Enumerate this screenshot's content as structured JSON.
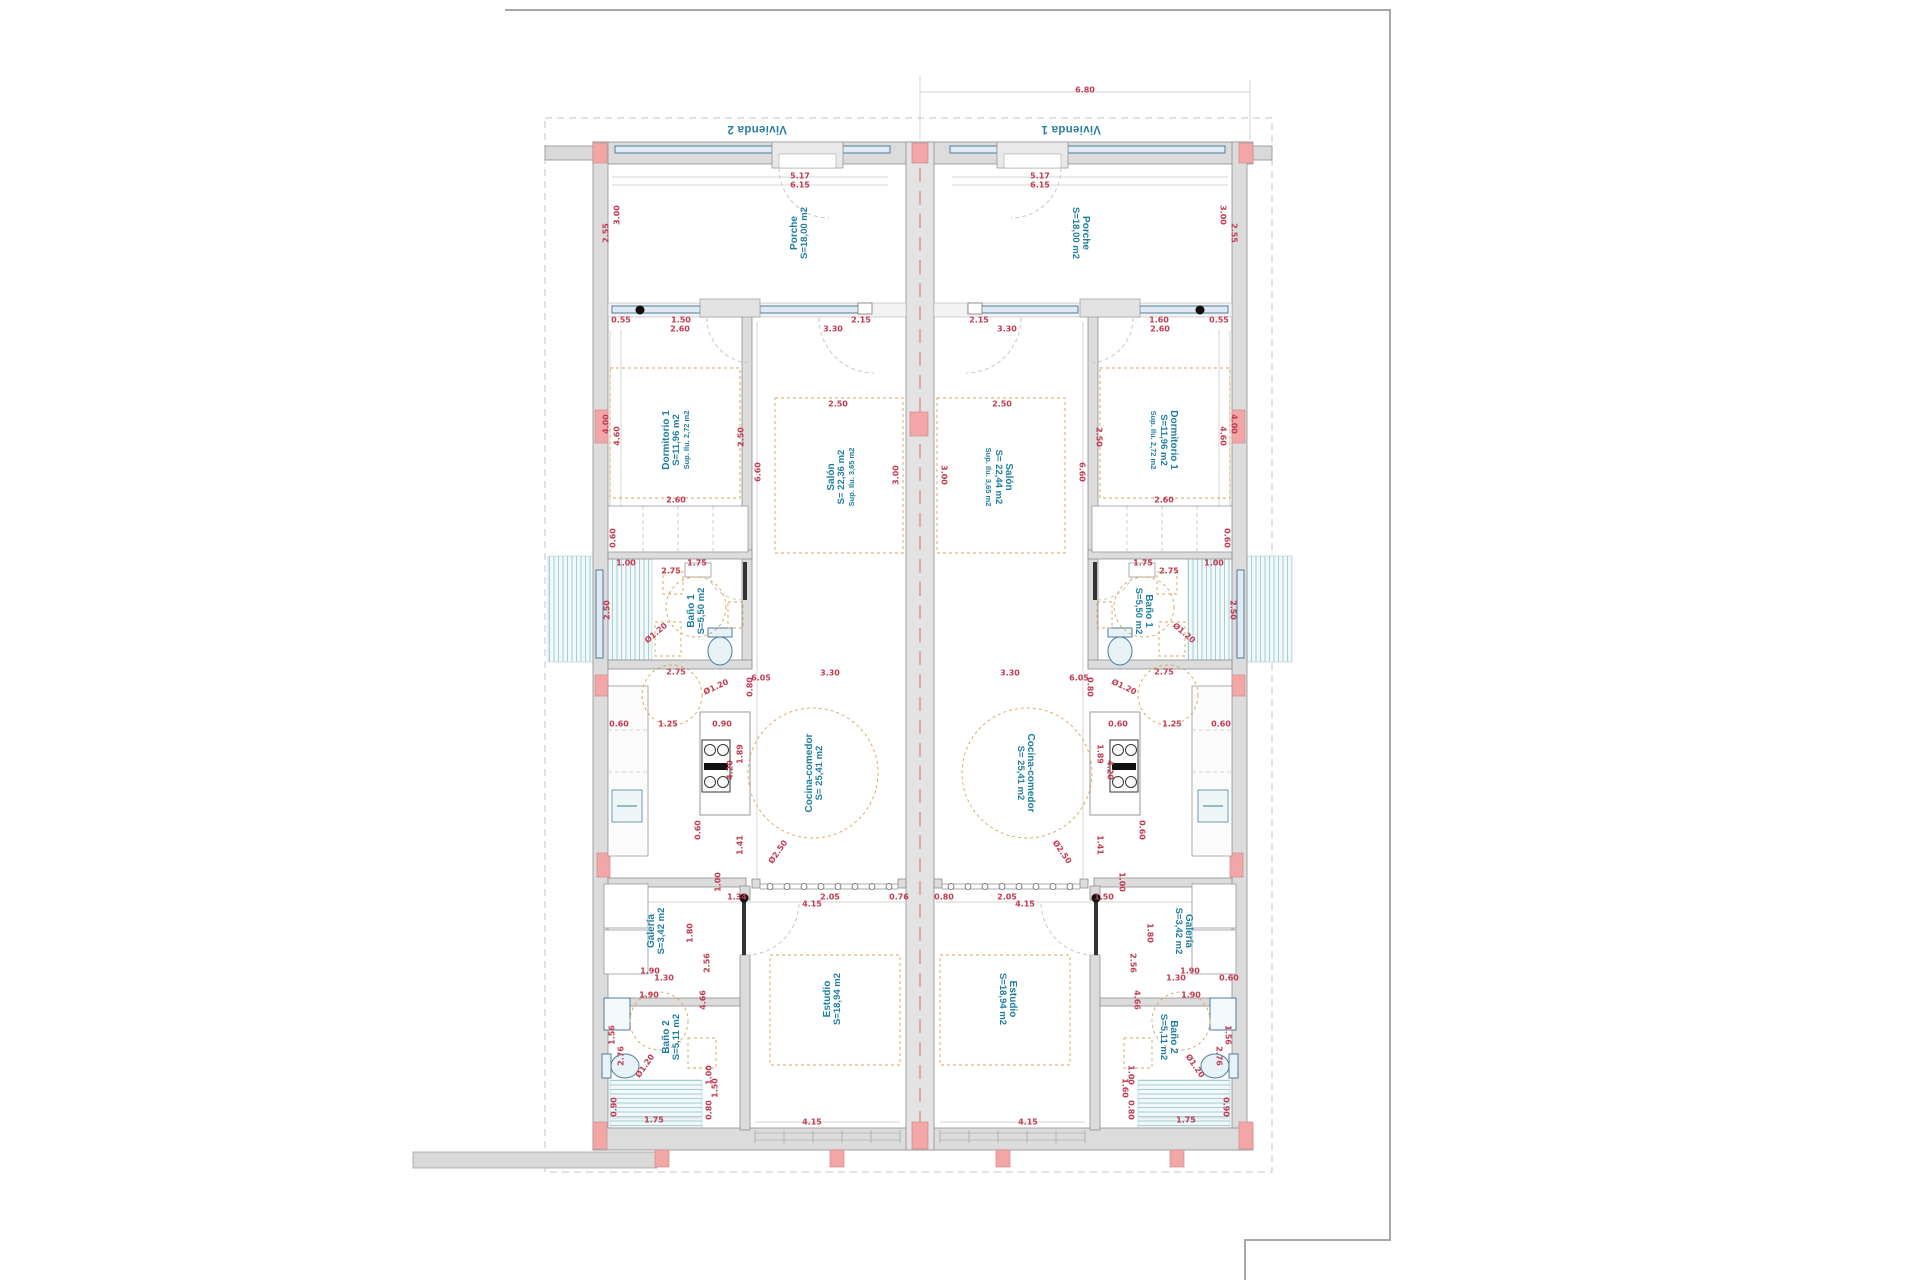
{
  "drawing_title": "floor-plan-two-mirrored-dwellings",
  "colors": {
    "wall_fill": "#dcdcdc",
    "wall_stroke": "#8f8f8f",
    "column_pink": "#f2a6a6",
    "window_blue": "#4e7d9e",
    "window_fill": "#dfeaf2",
    "tile_teal": "#a8ced4",
    "dimension_red": "#c13b52",
    "label_teal": "#1d7f9e",
    "furniture_tan": "#d8a45a",
    "party_wall_axis_red": "#e08585",
    "boundary_gray": "#c4c4c4",
    "paper_border_gray": "#a8a8a8"
  },
  "rooms": [
    {
      "lines": [
        "Vivienda 2"
      ],
      "x": 757,
      "y": 129,
      "rot": 180,
      "cls": "unit"
    },
    {
      "lines": [
        "Vivienda 1"
      ],
      "x": 1071,
      "y": 129,
      "rot": 180,
      "cls": "unit"
    },
    {
      "lines": [
        "Porche",
        "S=18,00 m2"
      ],
      "x": 800,
      "y": 233,
      "rot": -90,
      "cls": ""
    },
    {
      "lines": [
        "Porche",
        "S=18,00 m2"
      ],
      "x": 1080,
      "y": 233,
      "rot": 90,
      "cls": ""
    },
    {
      "lines": [
        "Dormitorio 1",
        "S=11,96 m2",
        "Sup. Ilu. 2,72 m2"
      ],
      "x": 676,
      "y": 440,
      "rot": -90,
      "cls": ""
    },
    {
      "lines": [
        "Dormitorio 1",
        "S=11,96 m2",
        "Sup. Ilu. 2,72 m2"
      ],
      "x": 1164,
      "y": 440,
      "rot": 90,
      "cls": ""
    },
    {
      "lines": [
        "Salón",
        "S= 22,36 m2",
        "Sup. Ilu. 3,65 m2"
      ],
      "x": 841,
      "y": 477,
      "rot": -90,
      "cls": ""
    },
    {
      "lines": [
        "Salón",
        "S= 22,44 m2",
        "Sup. Ilu. 3,65 m2"
      ],
      "x": 999,
      "y": 477,
      "rot": 90,
      "cls": ""
    },
    {
      "lines": [
        "Baño 1",
        "S=5,50 m2"
      ],
      "x": 697,
      "y": 611,
      "rot": -90,
      "cls": ""
    },
    {
      "lines": [
        "Baño 1",
        "S=5,50 m2"
      ],
      "x": 1143,
      "y": 611,
      "rot": 90,
      "cls": ""
    },
    {
      "lines": [
        "Cocina-comedor",
        "S= 25,41 m2"
      ],
      "x": 815,
      "y": 773,
      "rot": -90,
      "cls": ""
    },
    {
      "lines": [
        "Cocina-comedor",
        "S= 25,41 m2"
      ],
      "x": 1025,
      "y": 773,
      "rot": 90,
      "cls": ""
    },
    {
      "lines": [
        "Galería",
        "S=3,42 m2"
      ],
      "x": 657,
      "y": 931,
      "rot": -90,
      "cls": ""
    },
    {
      "lines": [
        "Galería",
        "S=3,42 m2"
      ],
      "x": 1183,
      "y": 931,
      "rot": 90,
      "cls": ""
    },
    {
      "lines": [
        "Baño 2",
        "S=5,11 m2"
      ],
      "x": 672,
      "y": 1037,
      "rot": -90,
      "cls": ""
    },
    {
      "lines": [
        "Baño 2",
        "S=5,11 m2"
      ],
      "x": 1168,
      "y": 1037,
      "rot": 90,
      "cls": ""
    },
    {
      "lines": [
        "Estudio",
        "S=18,94 m2"
      ],
      "x": 833,
      "y": 999,
      "rot": -90,
      "cls": ""
    },
    {
      "lines": [
        "Estudio",
        "S=18,94 m2"
      ],
      "x": 1007,
      "y": 999,
      "rot": 90,
      "cls": ""
    }
  ],
  "dimensions": [
    {
      "t": "6.80",
      "x": 1085,
      "y": 90,
      "r": 0
    },
    {
      "t": "5.17",
      "x": 800,
      "y": 176,
      "r": 0
    },
    {
      "t": "6.15",
      "x": 800,
      "y": 185,
      "r": 0
    },
    {
      "t": "5.17",
      "x": 1040,
      "y": 176,
      "r": 0
    },
    {
      "t": "6.15",
      "x": 1040,
      "y": 185,
      "r": 0
    },
    {
      "t": "3.00",
      "x": 617,
      "y": 215,
      "r": -90
    },
    {
      "t": "2.55",
      "x": 606,
      "y": 233,
      "r": -90
    },
    {
      "t": "3.00",
      "x": 1223,
      "y": 215,
      "r": 90
    },
    {
      "t": "2.55",
      "x": 1234,
      "y": 233,
      "r": 90
    },
    {
      "t": "0.55",
      "x": 621,
      "y": 320,
      "r": 0
    },
    {
      "t": "1.50",
      "x": 681,
      "y": 320,
      "r": 0
    },
    {
      "t": "2.60",
      "x": 680,
      "y": 329,
      "r": 0
    },
    {
      "t": "3.30",
      "x": 833,
      "y": 329,
      "r": 0
    },
    {
      "t": "2.15",
      "x": 861,
      "y": 320,
      "r": 0
    },
    {
      "t": "2.15",
      "x": 979,
      "y": 320,
      "r": 0
    },
    {
      "t": "3.30",
      "x": 1007,
      "y": 329,
      "r": 0
    },
    {
      "t": "1.60",
      "x": 1159,
      "y": 320,
      "r": 0
    },
    {
      "t": "2.60",
      "x": 1160,
      "y": 329,
      "r": 0
    },
    {
      "t": "0.55",
      "x": 1219,
      "y": 320,
      "r": 0
    },
    {
      "t": "4.00",
      "x": 606,
      "y": 424,
      "r": -90
    },
    {
      "t": "4.60",
      "x": 617,
      "y": 436,
      "r": -90
    },
    {
      "t": "4.00",
      "x": 1234,
      "y": 424,
      "r": 90
    },
    {
      "t": "4.60",
      "x": 1223,
      "y": 436,
      "r": 90
    },
    {
      "t": "2.50",
      "x": 741,
      "y": 437,
      "r": -90
    },
    {
      "t": "2.50",
      "x": 1099,
      "y": 437,
      "r": 90
    },
    {
      "t": "2.60",
      "x": 676,
      "y": 500,
      "r": 0
    },
    {
      "t": "2.60",
      "x": 1164,
      "y": 500,
      "r": 0
    },
    {
      "t": "6.60",
      "x": 758,
      "y": 472,
      "r": -90
    },
    {
      "t": "6.60",
      "x": 1082,
      "y": 472,
      "r": 90
    },
    {
      "t": "0.60",
      "x": 613,
      "y": 538,
      "r": -90
    },
    {
      "t": "0.60",
      "x": 1227,
      "y": 538,
      "r": 90
    },
    {
      "t": "2.50",
      "x": 838,
      "y": 404,
      "r": 0
    },
    {
      "t": "2.50",
      "x": 1002,
      "y": 404,
      "r": 0
    },
    {
      "t": "3.00",
      "x": 896,
      "y": 475,
      "r": -90
    },
    {
      "t": "3.00",
      "x": 944,
      "y": 475,
      "r": 90
    },
    {
      "t": "1.00",
      "x": 626,
      "y": 563,
      "r": 0
    },
    {
      "t": "1.75",
      "x": 697,
      "y": 563,
      "r": 0
    },
    {
      "t": "2.75",
      "x": 671,
      "y": 571,
      "r": 0
    },
    {
      "t": "1.00",
      "x": 1214,
      "y": 563,
      "r": 0
    },
    {
      "t": "1.75",
      "x": 1143,
      "y": 563,
      "r": 0
    },
    {
      "t": "2.75",
      "x": 1169,
      "y": 571,
      "r": 0
    },
    {
      "t": "2.50",
      "x": 607,
      "y": 610,
      "r": -90
    },
    {
      "t": "2.50",
      "x": 1233,
      "y": 610,
      "r": 90
    },
    {
      "t": "Ø1.20",
      "x": 656,
      "y": 633,
      "r": -40
    },
    {
      "t": "Ø1.20",
      "x": 1184,
      "y": 633,
      "r": 40
    },
    {
      "t": "2.75",
      "x": 676,
      "y": 672,
      "r": 0
    },
    {
      "t": "6.05",
      "x": 761,
      "y": 678,
      "r": 0
    },
    {
      "t": "3.30",
      "x": 830,
      "y": 673,
      "r": 0
    },
    {
      "t": "2.75",
      "x": 1164,
      "y": 672,
      "r": 0
    },
    {
      "t": "6.05",
      "x": 1079,
      "y": 678,
      "r": 0
    },
    {
      "t": "3.30",
      "x": 1010,
      "y": 673,
      "r": 0
    },
    {
      "t": "Ø1.20",
      "x": 716,
      "y": 687,
      "r": -25
    },
    {
      "t": "Ø1.20",
      "x": 1124,
      "y": 687,
      "r": 25
    },
    {
      "t": "0.80",
      "x": 750,
      "y": 687,
      "r": -90
    },
    {
      "t": "0.80",
      "x": 1090,
      "y": 687,
      "r": 90
    },
    {
      "t": "0.60",
      "x": 619,
      "y": 724,
      "r": 0
    },
    {
      "t": "1.25",
      "x": 668,
      "y": 724,
      "r": 0
    },
    {
      "t": "0.90",
      "x": 722,
      "y": 724,
      "r": 0
    },
    {
      "t": "0.60",
      "x": 1221,
      "y": 724,
      "r": 0
    },
    {
      "t": "1.25",
      "x": 1172,
      "y": 724,
      "r": 0
    },
    {
      "t": "0.60",
      "x": 1118,
      "y": 724,
      "r": 0
    },
    {
      "t": "1.89",
      "x": 740,
      "y": 754,
      "r": -90
    },
    {
      "t": "4.20",
      "x": 730,
      "y": 770,
      "r": -90
    },
    {
      "t": "1.89",
      "x": 1100,
      "y": 754,
      "r": 90
    },
    {
      "t": "4.20",
      "x": 1110,
      "y": 770,
      "r": 90
    },
    {
      "t": "0.60",
      "x": 698,
      "y": 830,
      "r": -90
    },
    {
      "t": "0.60",
      "x": 1142,
      "y": 830,
      "r": 90
    },
    {
      "t": "1.41",
      "x": 740,
      "y": 845,
      "r": -90
    },
    {
      "t": "1.41",
      "x": 1100,
      "y": 845,
      "r": 90
    },
    {
      "t": "Ø2.50",
      "x": 778,
      "y": 852,
      "r": -55
    },
    {
      "t": "Ø2.50",
      "x": 1062,
      "y": 852,
      "r": 55
    },
    {
      "t": "1.00",
      "x": 718,
      "y": 882,
      "r": -90
    },
    {
      "t": "1.00",
      "x": 1122,
      "y": 882,
      "r": 90
    },
    {
      "t": "1.34",
      "x": 737,
      "y": 897,
      "r": 0
    },
    {
      "t": "2.05",
      "x": 830,
      "y": 897,
      "r": 0
    },
    {
      "t": "0.76",
      "x": 899,
      "y": 897,
      "r": 0
    },
    {
      "t": "4.15",
      "x": 812,
      "y": 904,
      "r": 0
    },
    {
      "t": "0.80",
      "x": 944,
      "y": 897,
      "r": 0
    },
    {
      "t": "2.05",
      "x": 1007,
      "y": 897,
      "r": 0
    },
    {
      "t": "1.50",
      "x": 1104,
      "y": 897,
      "r": 0
    },
    {
      "t": "4.15",
      "x": 1025,
      "y": 904,
      "r": 0
    },
    {
      "t": "1.80",
      "x": 690,
      "y": 933,
      "r": -90
    },
    {
      "t": "2.56",
      "x": 707,
      "y": 963,
      "r": -90
    },
    {
      "t": "1.80",
      "x": 1150,
      "y": 933,
      "r": 90
    },
    {
      "t": "2.56",
      "x": 1133,
      "y": 963,
      "r": 90
    },
    {
      "t": "1.90",
      "x": 650,
      "y": 971,
      "r": 0
    },
    {
      "t": "1.30",
      "x": 664,
      "y": 978,
      "r": 0
    },
    {
      "t": "1.90",
      "x": 1190,
      "y": 971,
      "r": 0
    },
    {
      "t": "1.30",
      "x": 1176,
      "y": 978,
      "r": 0
    },
    {
      "t": "0.60",
      "x": 1229,
      "y": 978,
      "r": 0
    },
    {
      "t": "4.66",
      "x": 703,
      "y": 1000,
      "r": -90
    },
    {
      "t": "4.66",
      "x": 1137,
      "y": 1000,
      "r": 90
    },
    {
      "t": "1.90",
      "x": 649,
      "y": 995,
      "r": 0
    },
    {
      "t": "1.90",
      "x": 1191,
      "y": 995,
      "r": 0
    },
    {
      "t": "1.56",
      "x": 612,
      "y": 1035,
      "r": -90
    },
    {
      "t": "2.76",
      "x": 621,
      "y": 1056,
      "r": -90
    },
    {
      "t": "Ø1.20",
      "x": 645,
      "y": 1066,
      "r": -55
    },
    {
      "t": "1.00",
      "x": 709,
      "y": 1075,
      "r": -90
    },
    {
      "t": "1.50",
      "x": 715,
      "y": 1088,
      "r": -90
    },
    {
      "t": "0.90",
      "x": 614,
      "y": 1107,
      "r": -90
    },
    {
      "t": "0.80",
      "x": 709,
      "y": 1110,
      "r": -90
    },
    {
      "t": "1.75",
      "x": 654,
      "y": 1120,
      "r": 0
    },
    {
      "t": "1.56",
      "x": 1228,
      "y": 1035,
      "r": 90
    },
    {
      "t": "2.76",
      "x": 1219,
      "y": 1056,
      "r": 90
    },
    {
      "t": "Ø1.20",
      "x": 1195,
      "y": 1066,
      "r": 55
    },
    {
      "t": "1.00",
      "x": 1131,
      "y": 1075,
      "r": 90
    },
    {
      "t": "1.60",
      "x": 1125,
      "y": 1088,
      "r": 90
    },
    {
      "t": "0.90",
      "x": 1226,
      "y": 1107,
      "r": 90
    },
    {
      "t": "0.80",
      "x": 1131,
      "y": 1110,
      "r": 90
    },
    {
      "t": "1.75",
      "x": 1186,
      "y": 1120,
      "r": 0
    },
    {
      "t": "4.15",
      "x": 812,
      "y": 1122,
      "r": 0
    },
    {
      "t": "4.15",
      "x": 1028,
      "y": 1122,
      "r": 0
    }
  ]
}
